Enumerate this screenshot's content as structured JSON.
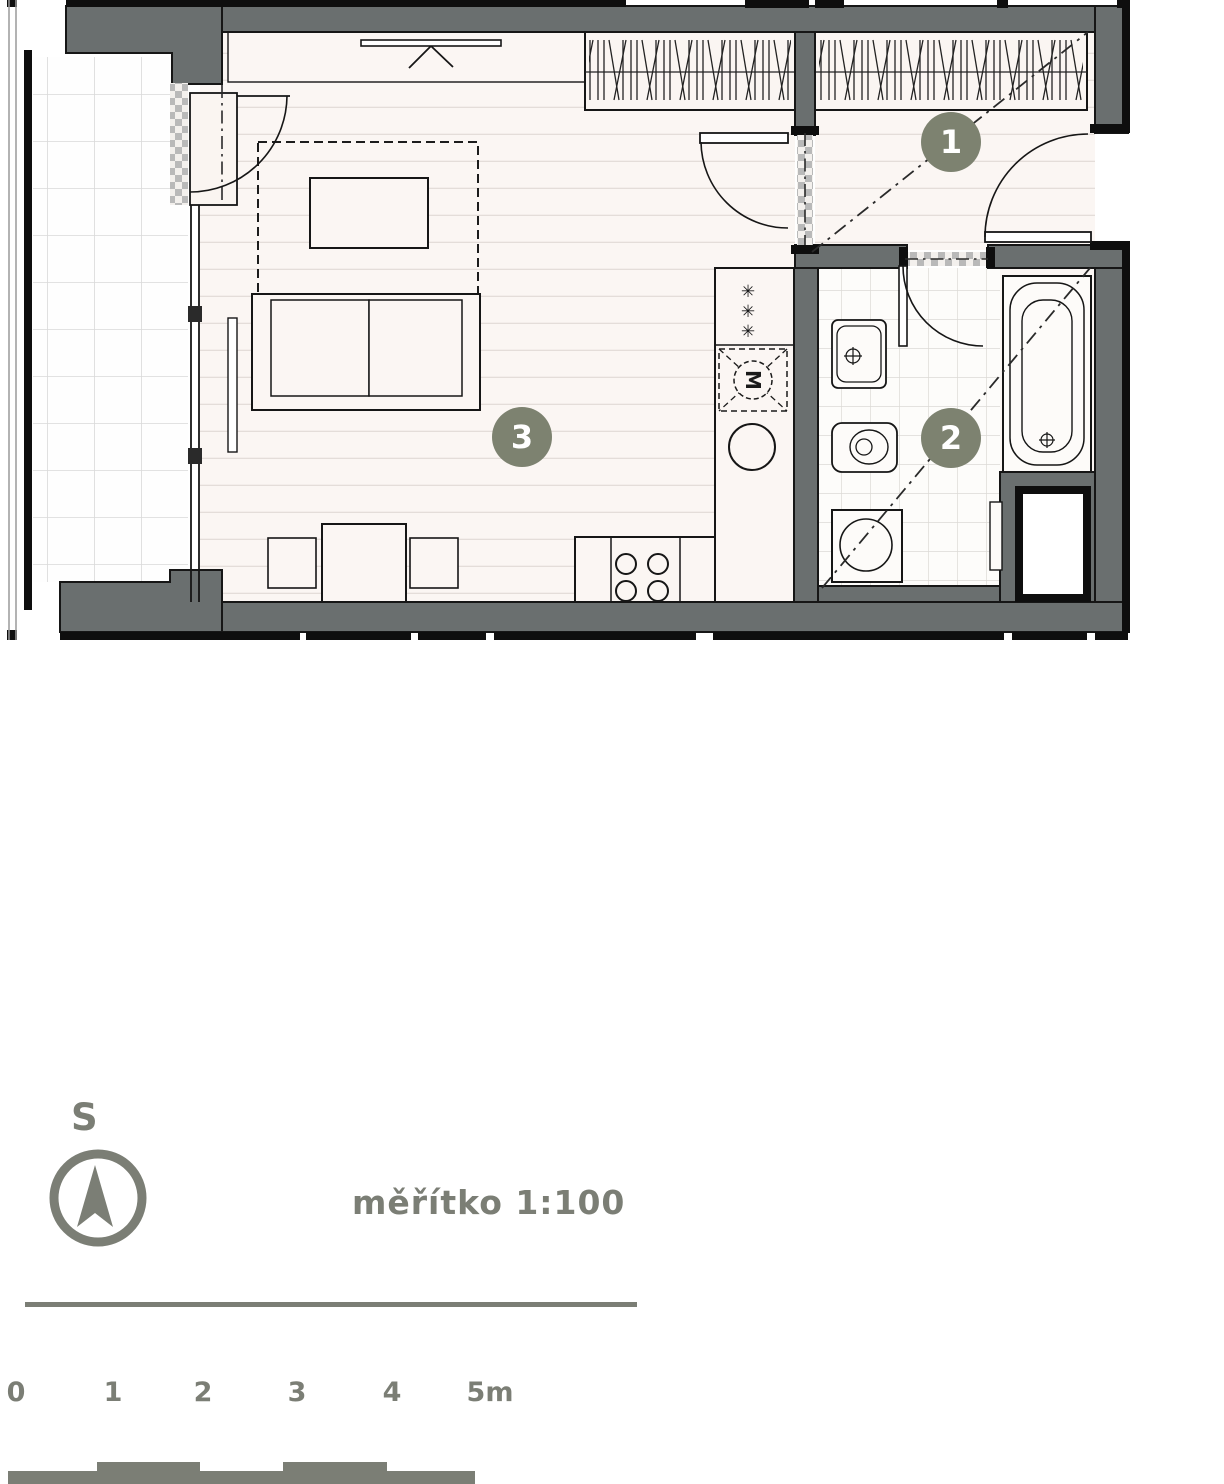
{
  "rooms": [
    {
      "number": "1"
    },
    {
      "number": "2"
    },
    {
      "number": "3"
    }
  ],
  "plan": {
    "kitchen": {
      "freezer_symbol": "✳",
      "hood_symbol": "M"
    }
  },
  "legend": {
    "north_label": "S",
    "scale_text": "měřítko 1:100",
    "scale_ticks": [
      "0",
      "1",
      "2",
      "3",
      "4",
      "5m"
    ]
  },
  "colors": {
    "wall_gray": "#6a6f6f",
    "line_black": "#161616",
    "floor_light": "#fbf6f3",
    "badge_olive": "#7d8270",
    "legend_gray": "#7b7e75"
  }
}
